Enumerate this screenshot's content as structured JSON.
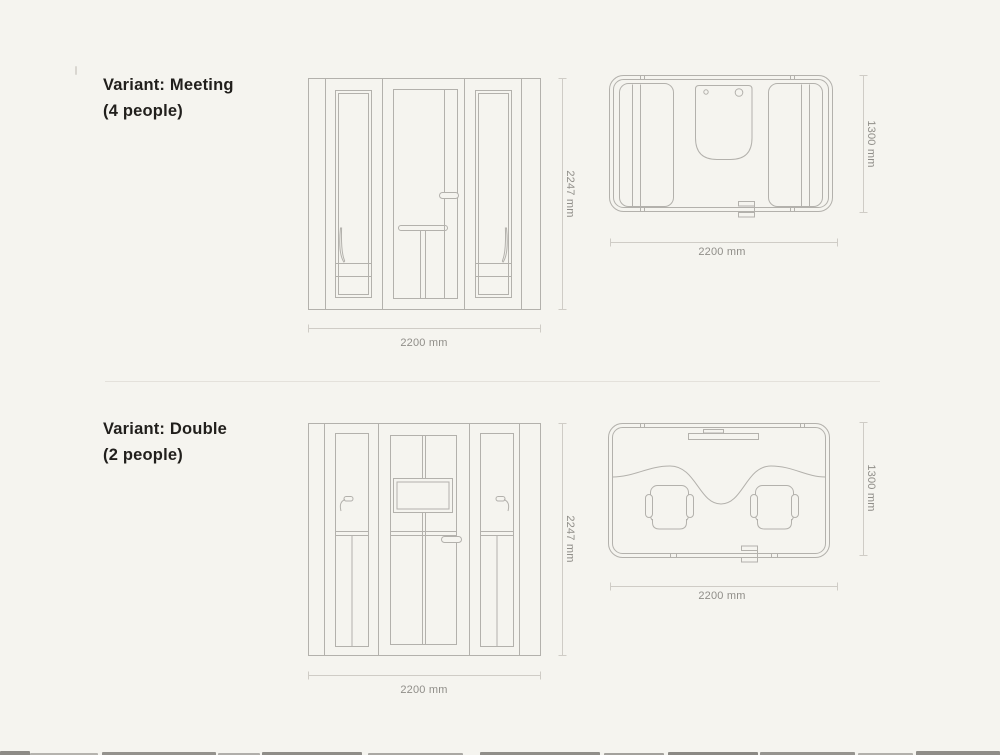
{
  "page": {
    "background": "#f5f4ef",
    "drawing_line_color": "#b3b1ac",
    "dimension_line_color": "#cfccc6",
    "dimension_text_color": "#908e89",
    "title_color": "#211f1c"
  },
  "sections": [
    {
      "title_line1": "Variant: Meeting",
      "title_line2": "(4 people)",
      "front_view": {
        "height_label": "2247 mm",
        "width_label": "2200 mm"
      },
      "top_view": {
        "depth_label": "1300 mm",
        "width_label": "2200 mm"
      }
    },
    {
      "title_line1": "Variant: Double",
      "title_line2": "(2 people)",
      "front_view": {
        "height_label": "2247 mm",
        "width_label": "2200 mm"
      },
      "top_view": {
        "depth_label": "1300 mm",
        "width_label": "2200 mm"
      }
    }
  ]
}
